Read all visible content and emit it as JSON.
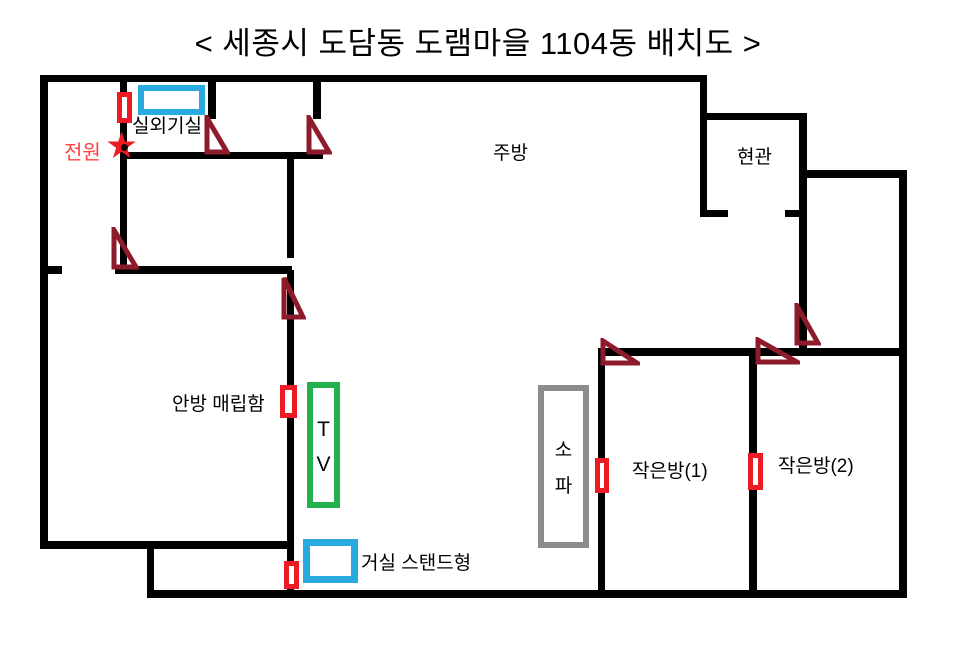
{
  "title": "< 세종시 도담동 도램마을 1104동 배치도 >",
  "rooms": {
    "outdoor_unit_room": "실외기실",
    "kitchen": "주방",
    "entrance": "현관",
    "small_room_1": "작은방(1)",
    "small_room_2": "작은방(2)"
  },
  "labels": {
    "power": "전원",
    "master_embedded_unit": "안방 매립함",
    "living_room_stand_unit": "거실 스탠드형",
    "tv_line_1": "T",
    "tv_line_2": "V",
    "sofa_line_1": "소",
    "sofa_line_2": "파"
  },
  "icons": {
    "power_star": "★"
  },
  "colors": {
    "wall_black": "#000000",
    "marker_red": "#ED1C24",
    "triangle_dark_red": "#8E1B2B",
    "accent_blue": "#29ABE2",
    "accent_green": "#22B14C",
    "accent_gray": "#8C8C8C",
    "power_text_red": "#FF4242",
    "background": "#FFFFFF"
  }
}
